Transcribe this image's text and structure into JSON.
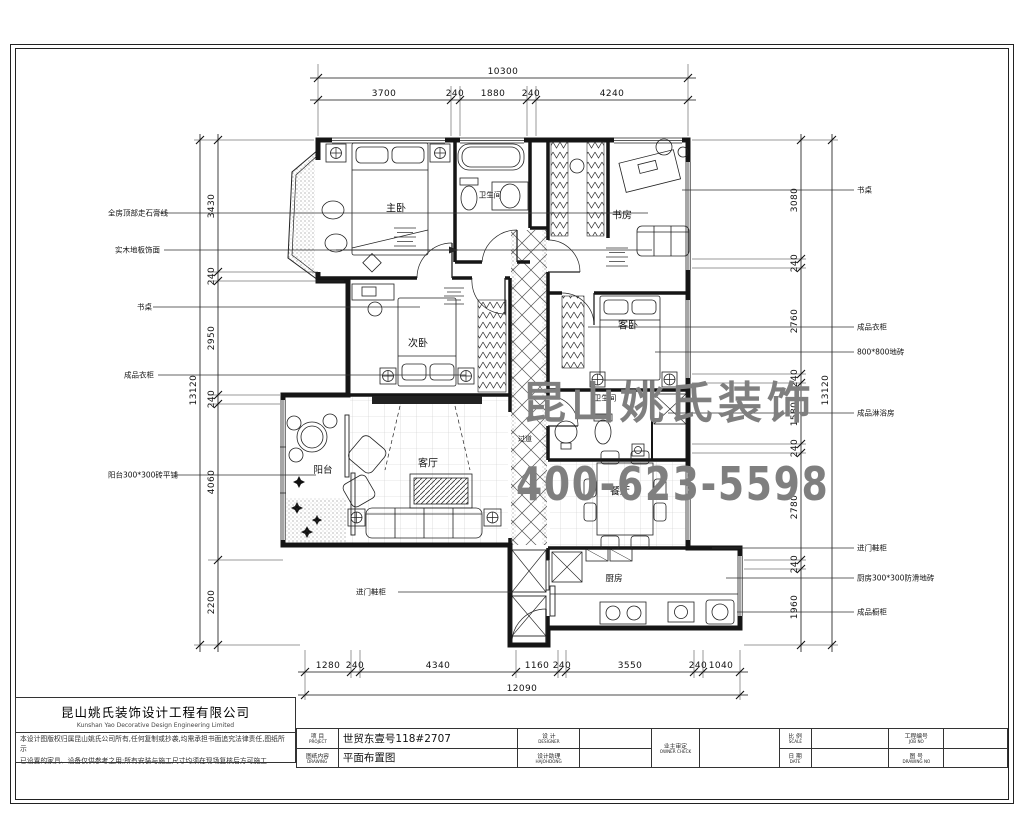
{
  "watermark": {
    "line1": "昆山姚氏装饰",
    "line2": "400-623-5598",
    "color": "#7f7f7f"
  },
  "company": {
    "name": "昆山姚氏装饰设计工程有限公司",
    "name_en": "Kunshan Yao Decorative Design Engineering Limited",
    "disclaimer1": "本设计图版权归属昆山姚氏公司所有,任何复制或抄袭,均需承担书面追究法律责任,图纸所示",
    "disclaimer2": "已设置的家具、设备仅供参考之用;所有安装与施工尺寸均须在现场复核后方可施工"
  },
  "titleblock": {
    "project_cn": "项 目",
    "project_en": "PROJECT",
    "project_value": "世贸东壹号118#2707",
    "drawing_cn": "图纸内容",
    "drawing_en": "DRAWING",
    "drawing_value": "平面布置图",
    "designer_cn": "设 计",
    "designer_en": "DESIGNER",
    "designer_value": "",
    "assistant_cn": "设计助理",
    "assistant_en": "HAJOHDONG",
    "assistant_value": "",
    "owner_cn": "业主审定",
    "owner_en": "OWNER CHECK",
    "owner_value": "",
    "scale_cn": "比 例",
    "scale_en": "SCALE",
    "scale_value": "",
    "date_cn": "日 期",
    "date_en": "DATE",
    "date_value": "",
    "jobno_cn": "工程编号",
    "jobno_en": "JOB NO",
    "jobno_value": "",
    "drawno_cn": "图 号",
    "drawno_en": "DRAWING NO",
    "drawno_value": ""
  },
  "texts": {
    "dims_top": [
      {
        "t": "10300",
        "x": 503,
        "y": 72
      },
      {
        "t": "3700",
        "x": 384,
        "y": 94
      },
      {
        "t": "240",
        "x": 455,
        "y": 94
      },
      {
        "t": "1880",
        "x": 493,
        "y": 94
      },
      {
        "t": "240",
        "x": 531,
        "y": 94
      },
      {
        "t": "4240",
        "x": 612,
        "y": 94
      }
    ],
    "dims_bottom": [
      {
        "t": "1280",
        "x": 328,
        "y": 666
      },
      {
        "t": "240",
        "x": 355,
        "y": 666
      },
      {
        "t": "4340",
        "x": 438,
        "y": 666
      },
      {
        "t": "1160",
        "x": 537,
        "y": 666
      },
      {
        "t": "240",
        "x": 562,
        "y": 666
      },
      {
        "t": "3550",
        "x": 630,
        "y": 666
      },
      {
        "t": "240",
        "x": 698,
        "y": 666
      },
      {
        "t": "1040",
        "x": 721,
        "y": 666
      },
      {
        "t": "12090",
        "x": 522,
        "y": 689
      }
    ],
    "dims_left": [
      {
        "t": "3430",
        "x": 212,
        "y": 206
      },
      {
        "t": "240",
        "x": 212,
        "y": 276
      },
      {
        "t": "2950",
        "x": 212,
        "y": 338
      },
      {
        "t": "240",
        "x": 212,
        "y": 399
      },
      {
        "t": "4060",
        "x": 212,
        "y": 482
      },
      {
        "t": "2200",
        "x": 212,
        "y": 602
      },
      {
        "t": "13120",
        "x": 194,
        "y": 390
      }
    ],
    "dims_right": [
      {
        "t": "3080",
        "x": 795,
        "y": 200
      },
      {
        "t": "240",
        "x": 795,
        "y": 263
      },
      {
        "t": "2760",
        "x": 795,
        "y": 321
      },
      {
        "t": "240",
        "x": 795,
        "y": 378
      },
      {
        "t": "1580",
        "x": 795,
        "y": 414
      },
      {
        "t": "240",
        "x": 795,
        "y": 448
      },
      {
        "t": "2780",
        "x": 795,
        "y": 507
      },
      {
        "t": "240",
        "x": 795,
        "y": 564
      },
      {
        "t": "1960",
        "x": 795,
        "y": 607
      },
      {
        "t": "13120",
        "x": 826,
        "y": 390
      }
    ],
    "rooms": [
      {
        "t": "主卧",
        "x": 396,
        "y": 207
      },
      {
        "t": "卫生间",
        "x": 490,
        "y": 195,
        "s": 7.5
      },
      {
        "t": "书房",
        "x": 622,
        "y": 214
      },
      {
        "t": "次卧",
        "x": 418,
        "y": 342
      },
      {
        "t": "客卧",
        "x": 628,
        "y": 324
      },
      {
        "t": "卫生间",
        "x": 605,
        "y": 398,
        "s": 7.5
      },
      {
        "t": "过道",
        "x": 525,
        "y": 439,
        "s": 7
      },
      {
        "t": "客厅",
        "x": 428,
        "y": 462
      },
      {
        "t": "阳台",
        "x": 323,
        "y": 469,
        "s": 9.5
      },
      {
        "t": "餐厅",
        "x": 620,
        "y": 490
      },
      {
        "t": "厨房",
        "x": 614,
        "y": 578,
        "s": 8.5
      }
    ],
    "annotations_left": [
      {
        "t": "全房顶部走石膏线",
        "x": 108,
        "y": 213
      },
      {
        "t": "实木地板饰面",
        "x": 115,
        "y": 250
      },
      {
        "t": "书桌",
        "x": 137,
        "y": 307
      },
      {
        "t": "成品衣柜",
        "x": 124,
        "y": 375
      },
      {
        "t": "阳台300*300砖平铺",
        "x": 108,
        "y": 475
      },
      {
        "t": "进门鞋柜",
        "x": 356,
        "y": 592
      }
    ],
    "annotations_right": [
      {
        "t": "书桌",
        "x": 857,
        "y": 190
      },
      {
        "t": "成品衣柜",
        "x": 857,
        "y": 327
      },
      {
        "t": "800*800地砖",
        "x": 857,
        "y": 352
      },
      {
        "t": "成品淋浴房",
        "x": 857,
        "y": 413
      },
      {
        "t": "进门鞋柜",
        "x": 857,
        "y": 548
      },
      {
        "t": "厨房300*300防滑地砖",
        "x": 857,
        "y": 578
      },
      {
        "t": "成品橱柜",
        "x": 857,
        "y": 612
      }
    ]
  }
}
